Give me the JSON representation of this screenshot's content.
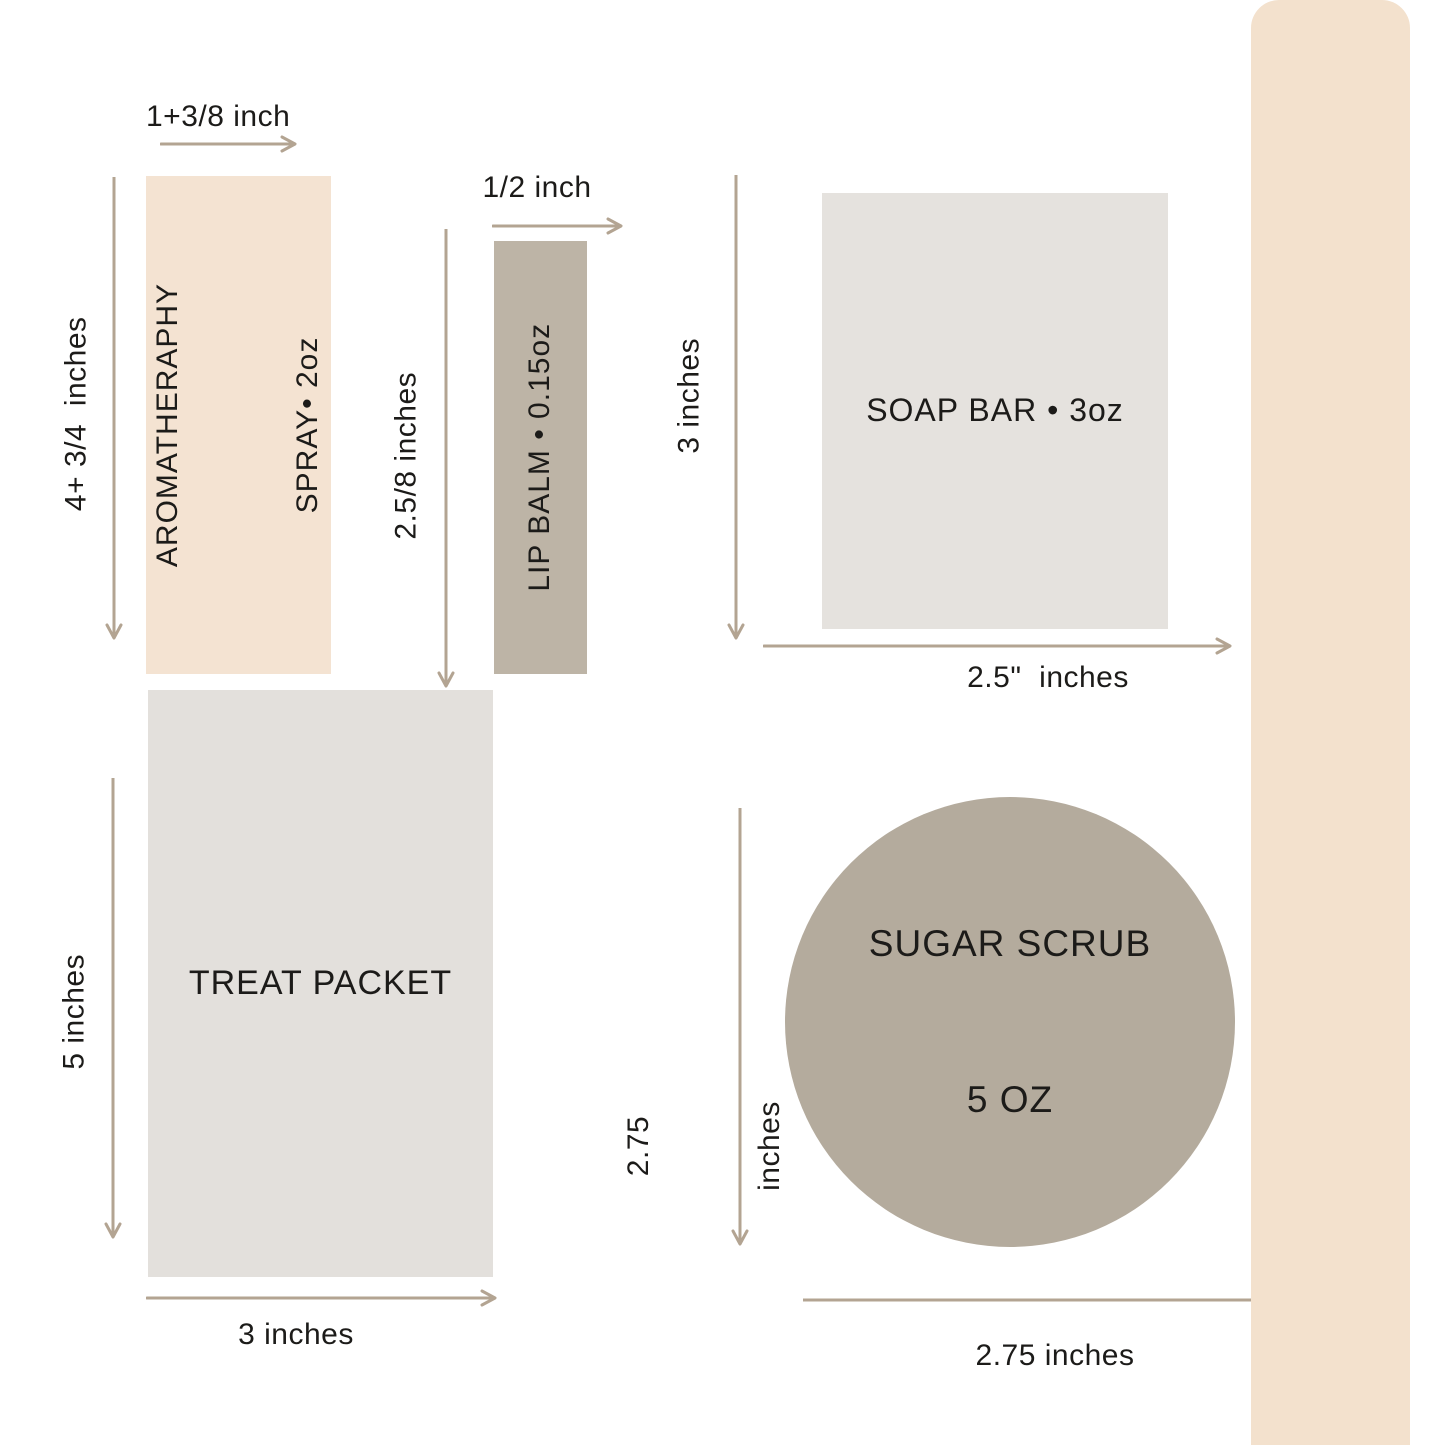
{
  "style": {
    "background": "#ffffff",
    "text_color": "#1c1b19",
    "arrow_color": "#b3a492"
  },
  "sidebar": {
    "label": "DIMENSIONS",
    "bg": "#f3e1cd",
    "text_color": "#ffffff"
  },
  "aromatherapy_spray": {
    "name_line1": "AROMATHERAPHY",
    "name_line2": "SPRAY• 2oz",
    "width_label": "1+3/8 inch",
    "height_label": "4+ 3/4  inches",
    "fill": "#f4e3d2"
  },
  "lip_balm": {
    "name": "LIP BALM • 0.15oz",
    "width_label": "1/2 inch",
    "height_label": "2.5/8 inches",
    "fill": "#bdb4a6"
  },
  "soap_bar": {
    "name": "SOAP BAR • 3oz",
    "width_label": "2.5\"  inches",
    "height_label": "3 inches",
    "fill": "#e5e2de"
  },
  "treat_packet": {
    "name": "TREAT PACKET",
    "width_label": "3 inches",
    "height_label": "5 inches",
    "fill": "#e3e0dc"
  },
  "sugar_scrub": {
    "name_line1": "SUGAR SCRUB",
    "name_line2": "5 OZ",
    "width_label": "2.75 inches",
    "height_label_line1": "2.75",
    "height_label_line2": "inches",
    "fill": "#b4ab9d"
  }
}
